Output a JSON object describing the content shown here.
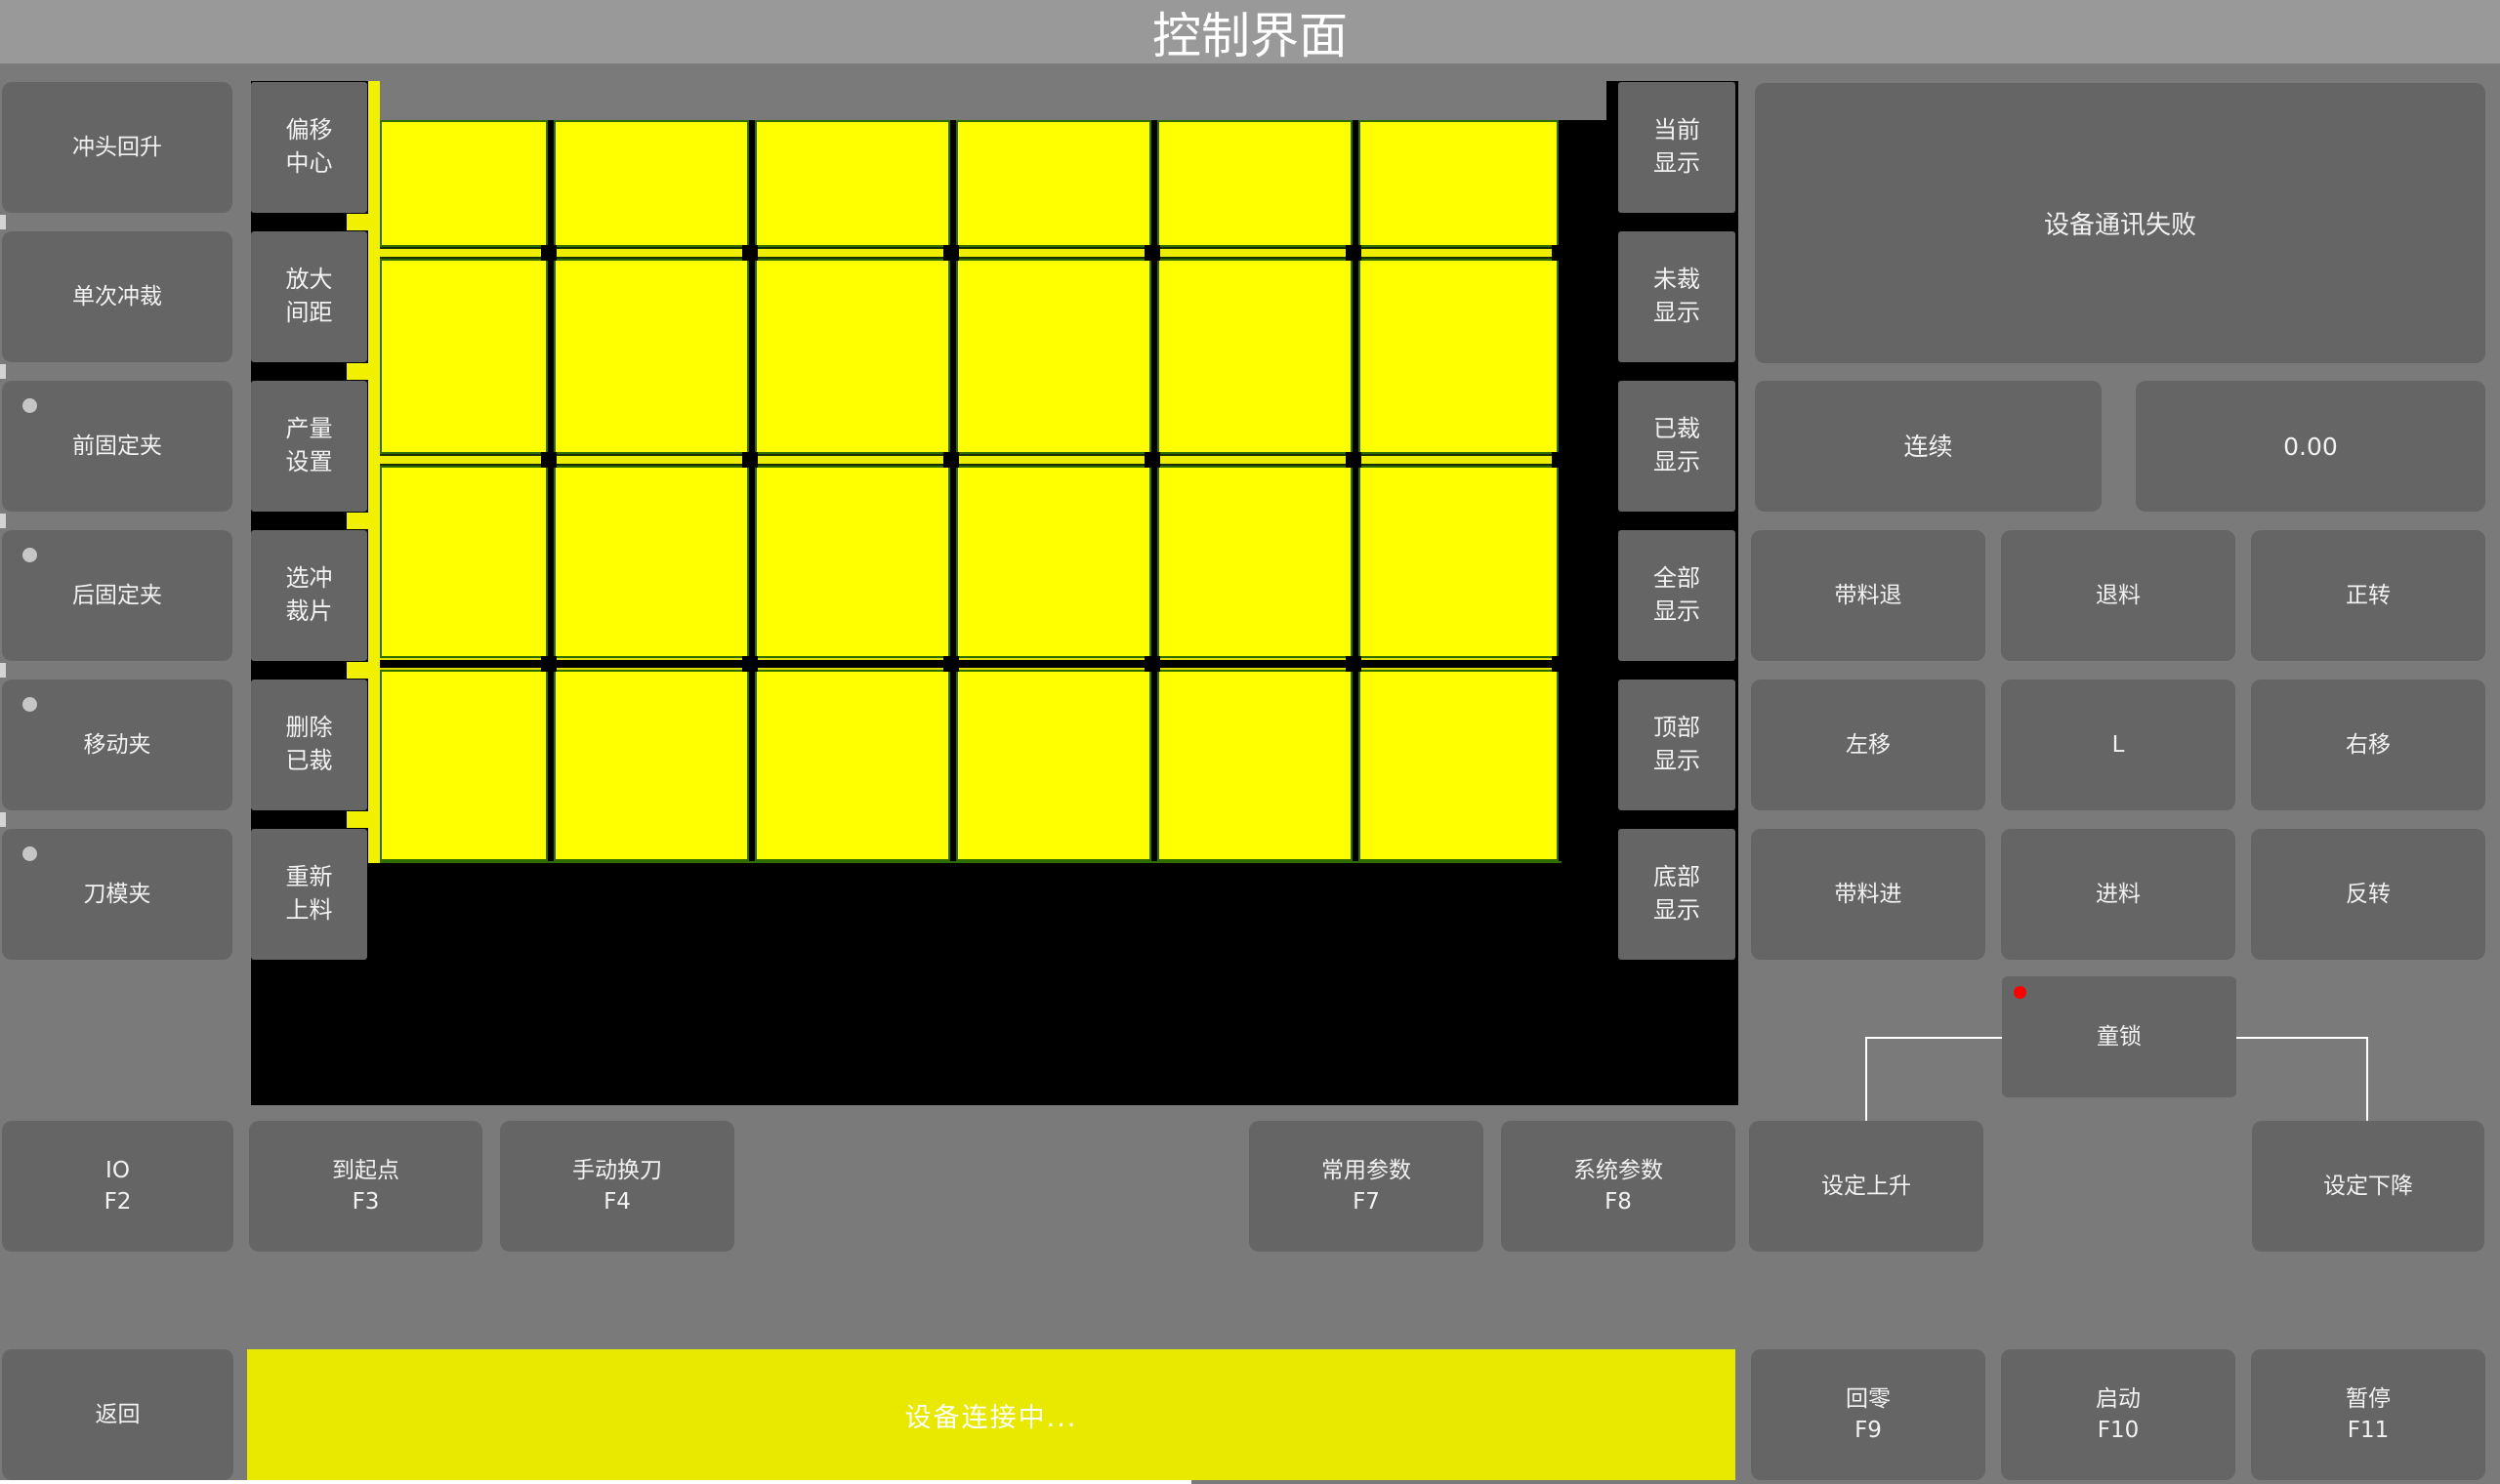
{
  "title": "控制界面",
  "left_column": {
    "items": [
      {
        "label": "冲头回升",
        "dot": false
      },
      {
        "label": "单次冲裁",
        "dot": false
      },
      {
        "label": "前固定夹",
        "dot": true
      },
      {
        "label": "后固定夹",
        "dot": true
      },
      {
        "label": "移动夹",
        "dot": true
      },
      {
        "label": "刀模夹",
        "dot": true
      }
    ]
  },
  "tool_column": {
    "items": [
      {
        "line1": "偏移",
        "line2": "中心"
      },
      {
        "line1": "放大",
        "line2": "间距"
      },
      {
        "line1": "产量",
        "line2": "设置"
      },
      {
        "line1": "选冲",
        "line2": "裁片"
      },
      {
        "line1": "删除",
        "line2": "已裁"
      },
      {
        "line1": "重新",
        "line2": "上料"
      }
    ]
  },
  "display_column": {
    "items": [
      {
        "line1": "当前",
        "line2": "显示"
      },
      {
        "line1": "未裁",
        "line2": "显示"
      },
      {
        "line1": "已裁",
        "line2": "显示"
      },
      {
        "line1": "全部",
        "line2": "显示"
      },
      {
        "line1": "顶部",
        "line2": "显示"
      },
      {
        "line1": "底部",
        "line2": "显示"
      }
    ]
  },
  "sheet_grid": {
    "columns": 6,
    "rows": 4,
    "piece_color": "#ffff00",
    "cut_line_color": "#2e6b00"
  },
  "right_panel": {
    "message": "设备通讯失败",
    "mode_button": "连续",
    "value_display": "0.00",
    "jog": [
      [
        "带料退",
        "退料",
        "正转"
      ],
      [
        "左移",
        "L",
        "右移"
      ],
      [
        "带料进",
        "进料",
        "反转"
      ]
    ],
    "child_lock": "童锁"
  },
  "function_row": [
    {
      "label": "IO",
      "fkey": "F2"
    },
    {
      "label": "到起点",
      "fkey": "F3"
    },
    {
      "label": "手动换刀",
      "fkey": "F4"
    },
    {
      "label": "常用参数",
      "fkey": "F7"
    },
    {
      "label": "系统参数",
      "fkey": "F8"
    },
    {
      "label": "设定上升",
      "fkey": ""
    },
    {
      "label": "设定下降",
      "fkey": ""
    }
  ],
  "bottom_bar": {
    "back": "返回",
    "status": "设备连接中...",
    "buttons": [
      {
        "label": "回零",
        "fkey": "F9"
      },
      {
        "label": "启动",
        "fkey": "F10"
      },
      {
        "label": "暂停",
        "fkey": "F11"
      }
    ]
  },
  "colors": {
    "title_bar": "#999999",
    "background": "#7a7a7a",
    "button": "#656565",
    "canvas_black": "#000000",
    "piece_yellow": "#ffff00",
    "status_yellow": "#e9e900",
    "alert_red": "#fe0000",
    "indicator_gray": "#c6c6c6"
  }
}
